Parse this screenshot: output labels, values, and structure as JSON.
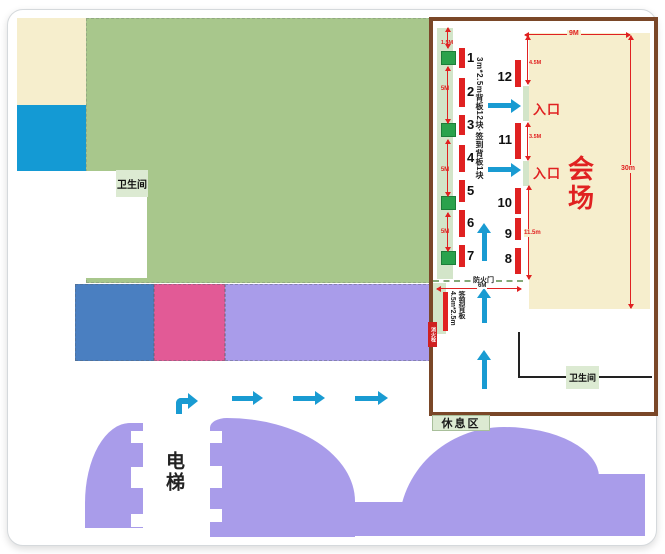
{
  "plan": {
    "toilet_label": "卫生间",
    "elevator_label": "电梯"
  },
  "panel": {
    "booths_left": [
      "1",
      "2",
      "3",
      "4",
      "5",
      "6",
      "7"
    ],
    "booths_mid": [
      "12",
      "11",
      "10",
      "9",
      "8"
    ],
    "left_dims": [
      "1.5M",
      "5M",
      "5M",
      "5M"
    ],
    "backboard_note": "3m*2.5m背板12块·签到背板1块",
    "hall_name": "会场",
    "hall_width_dim": "9M",
    "hall_height_dim": "30m",
    "door_dim_top": "4.5M",
    "door_dim_mid": "3.5M",
    "door_dim_bottom": "11.5m",
    "entrance_1": "入口",
    "entrance_2": "入口",
    "fire_door_label": "防火门",
    "fire_door_dim": "6M",
    "signin_board_label": "签到背板",
    "signin_board_size": "4.5m*2.5m",
    "wall_tag": "消火栓",
    "toilet_label": "卫生间",
    "rest_area_label": "休息区"
  },
  "colors": {
    "green_area": "#a8c78c",
    "cream": "#f6eecd",
    "bright_blue": "#149ad4",
    "steel_blue": "#4a7fc1",
    "pink": "#e25a96",
    "purple": "#a99cea",
    "arrow_cyan": "#199bd2",
    "red": "#e02121",
    "booth_green": "#2aa24c",
    "wall_strip_green": "#d3e5c9",
    "label_green": "#dcead2",
    "panel_border_brown": "#7a4728"
  }
}
